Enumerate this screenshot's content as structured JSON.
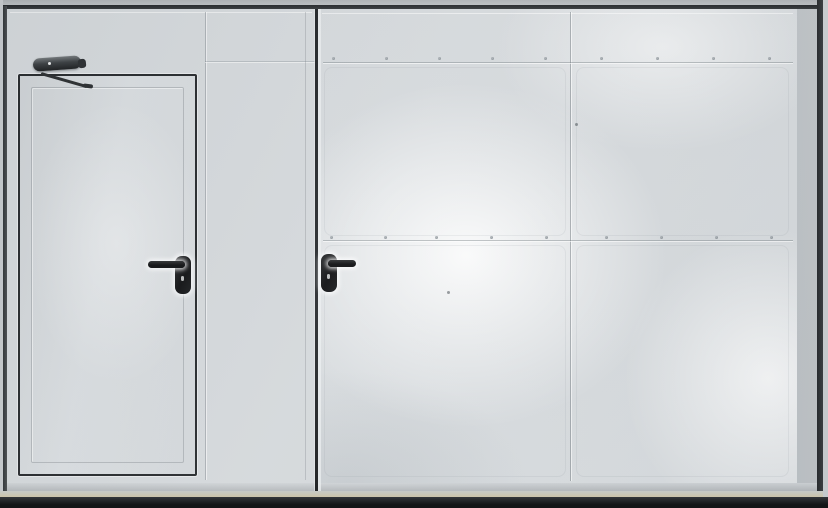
{
  "meta": {
    "description": "Photograph of white industrial metal doors: left gate leaf with built-in wicket door fitted with an overhead door closer and a black lever handle; right gate leaf with a black lever handle, panel seams and rivet rows; dark perimeter frame and floor strip.",
    "width_px": 828,
    "height_px": 508
  },
  "palette": {
    "panel_base": "#d6dadd",
    "panel_bright": "#f1f4f5",
    "panel_shadow": "#c3c7ca",
    "frame_dark": "#2b2e31",
    "door_outline": "#26292c",
    "handle_black": "#121315",
    "closer_gray": "#3c4043",
    "sill_tan": "#cbc4aa",
    "bottom_dark": "#1e2022"
  },
  "scene": {
    "left_leaf": {
      "label": "left gate leaf with wicket door",
      "vertical_seam_x": 205
    },
    "wicket_door": {
      "label": "wicket door",
      "outline": "thin dark rectangular outline with inner inset panel line",
      "closer": "overhead door closer with articulated arm, top-left",
      "handle": "black lever handle pointing left, with keyhole escutcheon"
    },
    "gap": {
      "label": "dark vertical gap between leaves",
      "x": 317
    },
    "right_leaf": {
      "label": "right gate leaf",
      "handle": "black lever handle pointing right, with keyhole escutcheon",
      "vertical_seam_x": 570,
      "horizontal_seam_ys": [
        62,
        240
      ]
    },
    "rivet_rows": [
      {
        "y": 57,
        "xs": [
          332,
          385,
          438,
          491,
          544,
          600,
          656,
          712,
          768
        ]
      },
      {
        "y": 236,
        "xs": [
          330,
          384,
          435,
          490,
          545,
          605,
          660,
          715,
          770
        ]
      }
    ],
    "specks": [
      {
        "x": 575,
        "y": 123
      },
      {
        "x": 447,
        "y": 291
      }
    ]
  }
}
